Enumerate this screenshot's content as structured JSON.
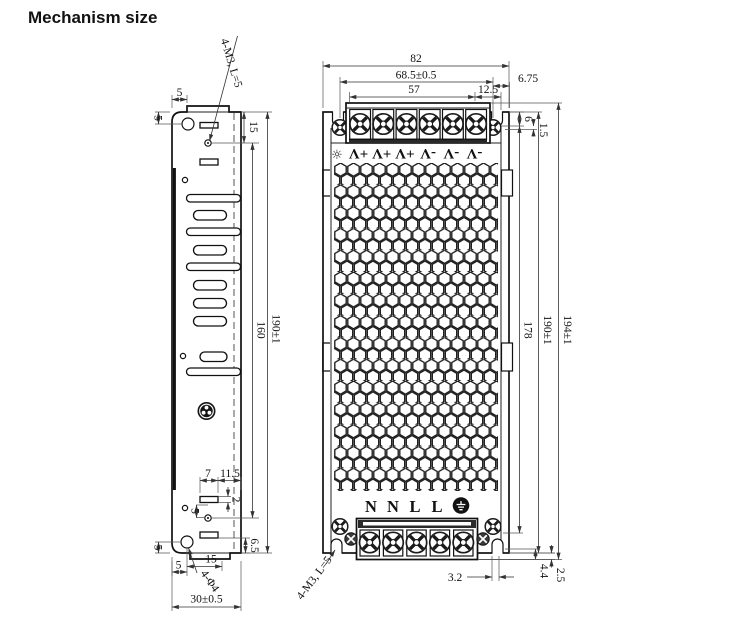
{
  "title": "Mechanism size",
  "side_view": {
    "callouts": {
      "screw_holes": "4-M3, L=5",
      "mount_holes": "4-Φ4"
    },
    "dims": {
      "tab_offset": "5",
      "hole_top_offset": "5",
      "screw_top_offset": "15",
      "screw_hole_span": "160",
      "body_height": "190±1",
      "slot_width": "7",
      "slot_right_offset": "11.5",
      "slot_height": "2",
      "screw_mid_offset": "5",
      "hole_bottom_offset": "5",
      "slot_bottom_offset": "6.5",
      "hole_left_offset": "5",
      "hole_tab_offset": "15",
      "body_width": "30±0.5"
    }
  },
  "front_view": {
    "callouts": {
      "screw_holes": "4-M3, L=5"
    },
    "terminal_labels": {
      "adjust": "☼",
      "output": [
        "+V",
        "+V",
        "+V",
        "-V",
        "-V",
        "-V"
      ],
      "input": [
        "N",
        "N",
        "L",
        "L"
      ],
      "ground_icon": "earth-ground"
    },
    "dims": {
      "body_width": "82",
      "mount_hole_span": "68.5±0.5",
      "terminal_span": "57",
      "terminal_right_offset": "12.5",
      "mount_edge_offset": "6.75",
      "top_inset": "6",
      "top_lip": "1.5",
      "inner_height": "178",
      "body_height": "190±1",
      "overall_height": "194±1",
      "notch_width": "3.2",
      "bottom_inset": "4.4",
      "bottom_lip": "2.5"
    }
  }
}
